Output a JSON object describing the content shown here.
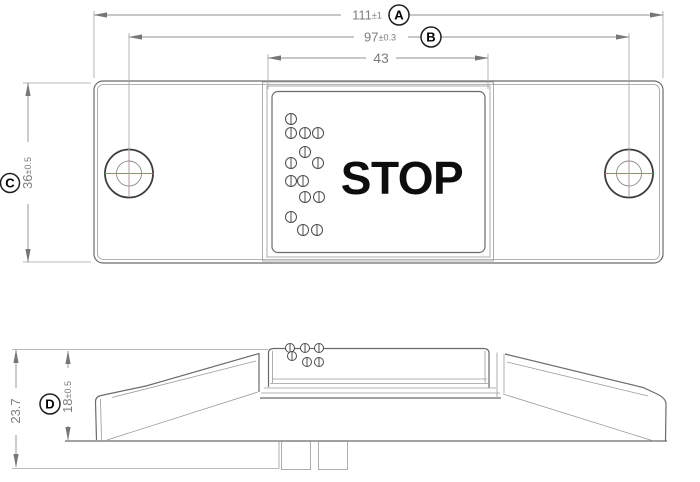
{
  "drawing": {
    "button_label": "STOP",
    "dims": {
      "overall_width": {
        "value": "111",
        "tol": "±1",
        "ref": "A"
      },
      "hole_spacing": {
        "value": "97",
        "tol": "±0.3",
        "ref": "B"
      },
      "button_width": {
        "value": "43"
      },
      "overall_height": {
        "value": "36",
        "tol": "±0.5",
        "ref": "C"
      },
      "body_height": {
        "value": "18",
        "tol": "±0.5",
        "ref": "D"
      },
      "total_height": {
        "value": "23.7"
      }
    },
    "colors": {
      "part_line": "#6b6b6b",
      "dimension_line": "#8f8f8f",
      "centerline_red": "#e06a6a",
      "label_text": "#7d7d7d",
      "stop_text": "#0d0d0d"
    },
    "braille_dots": {
      "top_view": [
        [
          291,
          119
        ],
        [
          291,
          133
        ],
        [
          305,
          133
        ],
        [
          318,
          133
        ],
        [
          305,
          152
        ],
        [
          291,
          163
        ],
        [
          318,
          163
        ],
        [
          291,
          181
        ],
        [
          303,
          181
        ],
        [
          305,
          197
        ],
        [
          319,
          197
        ],
        [
          291,
          217
        ],
        [
          303,
          230
        ],
        [
          317,
          230
        ]
      ],
      "side_view": [
        [
          290,
          348
        ],
        [
          305,
          348
        ],
        [
          319,
          348
        ],
        [
          292,
          356
        ],
        [
          307,
          362
        ],
        [
          319,
          362
        ]
      ]
    }
  }
}
